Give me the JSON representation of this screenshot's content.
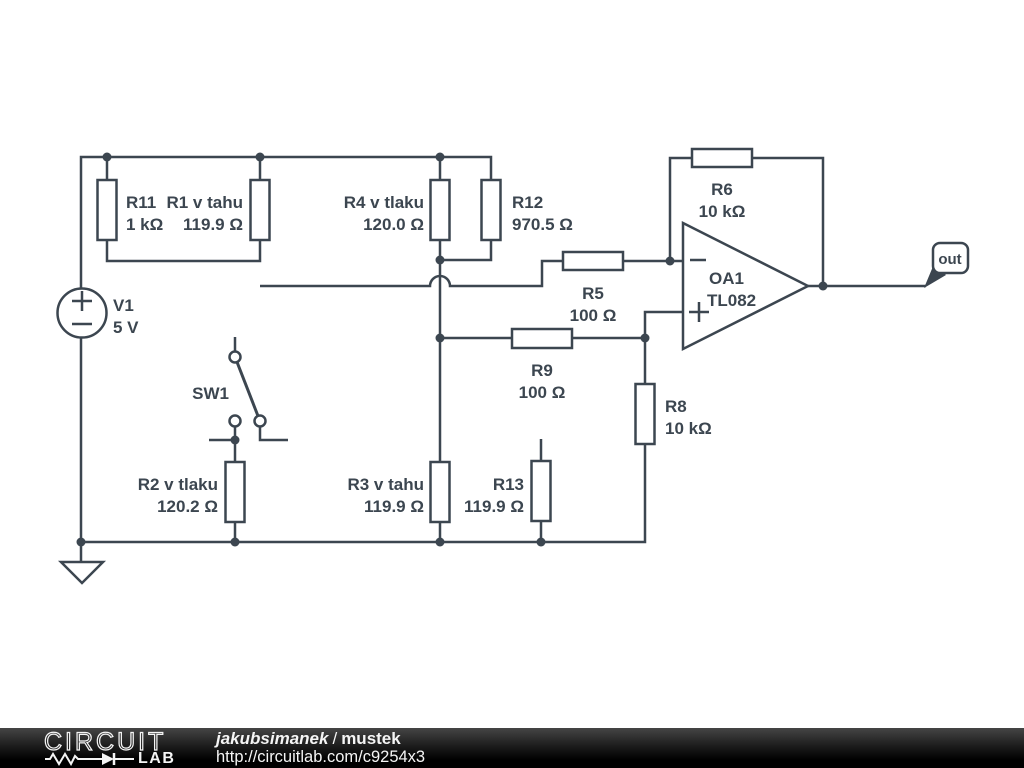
{
  "colors": {
    "schematic_stroke": "#3c4650",
    "background": "#ffffff",
    "footer_background": "#000000",
    "footer_text": "#f5f5f5"
  },
  "schematic": {
    "components": {
      "v1": {
        "name": "V1",
        "value": "5 V"
      },
      "r11": {
        "name": "R11",
        "value": "1 kΩ"
      },
      "r1": {
        "name": "R1 v tahu",
        "value": "119.9 Ω"
      },
      "r4": {
        "name": "R4 v tlaku",
        "value": "120.0 Ω"
      },
      "r12": {
        "name": "R12",
        "value": "970.5 Ω"
      },
      "r5": {
        "name": "R5",
        "value": "100 Ω"
      },
      "r6": {
        "name": "R6",
        "value": "10 kΩ"
      },
      "r9": {
        "name": "R9",
        "value": "100 Ω"
      },
      "r8": {
        "name": "R8",
        "value": "10 kΩ"
      },
      "oa1": {
        "name": "OA1",
        "value": "TL082"
      },
      "sw1": {
        "name": "SW1"
      },
      "r2": {
        "name": "R2 v tlaku",
        "value": "120.2 Ω"
      },
      "r3": {
        "name": "R3 v tahu",
        "value": "119.9 Ω"
      },
      "r13": {
        "name": "R13",
        "value": "119.9 Ω"
      },
      "out_flag": {
        "label": "out"
      }
    }
  },
  "footer": {
    "brand_top": "CIRCUIT",
    "brand_bottom": "LAB",
    "author": "jakubsimanek",
    "separator": "/",
    "project": "mustek",
    "url": "http://circuitlab.com/c9254x3"
  }
}
